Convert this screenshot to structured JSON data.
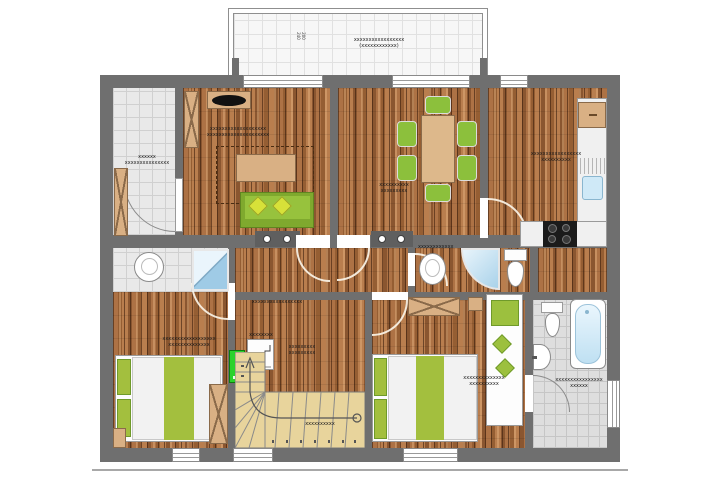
{
  "title": "apartment-floor-plan",
  "colors": {
    "wall": "#6f6f6f",
    "wood_floor": "#a06437",
    "entry_tile": "#e9e9e9",
    "bath_tile": "#dedede",
    "balcony_tile": "#f7f7f7",
    "stairs": "#e8d49c",
    "furniture_green": "#8cc03c",
    "cushion_yellow_green": "#d7e139",
    "marker_green": "#2bd22b",
    "furniture_tan": "#d9b084",
    "water_blue": "#bfe0f2",
    "stove_black": "#1b1b1b"
  },
  "balcony": {
    "label1": "xxxxxxxxxxxxxxxxx",
    "label2": "(xxxxxxxxxxxx)",
    "dim_top": "200",
    "dim_bottom": "240"
  },
  "rooms": {
    "entry": {
      "name": "entry hall",
      "l1": "xxxxxx",
      "l2": "xxxxxxxxxxxxxxx"
    },
    "living": {
      "name": "living room",
      "l1": "xxxxxxxxxxxxxxxxxxx",
      "l2": "xxxxxxxxxxxxxxxxxxxxx"
    },
    "dining": {
      "name": "dining room",
      "l1": "xxxxxxxxxx",
      "l2": "xxxxxxxxx"
    },
    "kitchen": {
      "name": "kitchen",
      "l1": "xxxxxxxxxxxxxxxxx",
      "l2": "xxxxxxxxxx"
    },
    "shower_wc": {
      "name": "shower-wc",
      "l1": "xxxxxxxxxxxx",
      "l2": "xxxxx"
    },
    "bedroom1": {
      "name": "bedroom 1",
      "l1": "xxxxxxxxxxxxxxxxxx",
      "l2": "xxxxxxxxxxxxxx"
    },
    "bedroom2": {
      "name": "bedroom 2",
      "l1": "xxxxxxxxxxxxxx",
      "l2": "xxxxxxxxxx"
    },
    "bathroom": {
      "name": "bathroom",
      "l1": "xxxxxxxxxxxxxxxx",
      "l2": "xxxxxx"
    }
  },
  "hall": {
    "note": "xxxxxxxxxxxxxxxxx"
  },
  "stairs": {
    "legend_title": "xxxxxxxx",
    "legend_note1": "xxxxxxxxx",
    "legend_note2": "xxxxxxxxx",
    "walk_note": "xxxxxxxxxx"
  }
}
